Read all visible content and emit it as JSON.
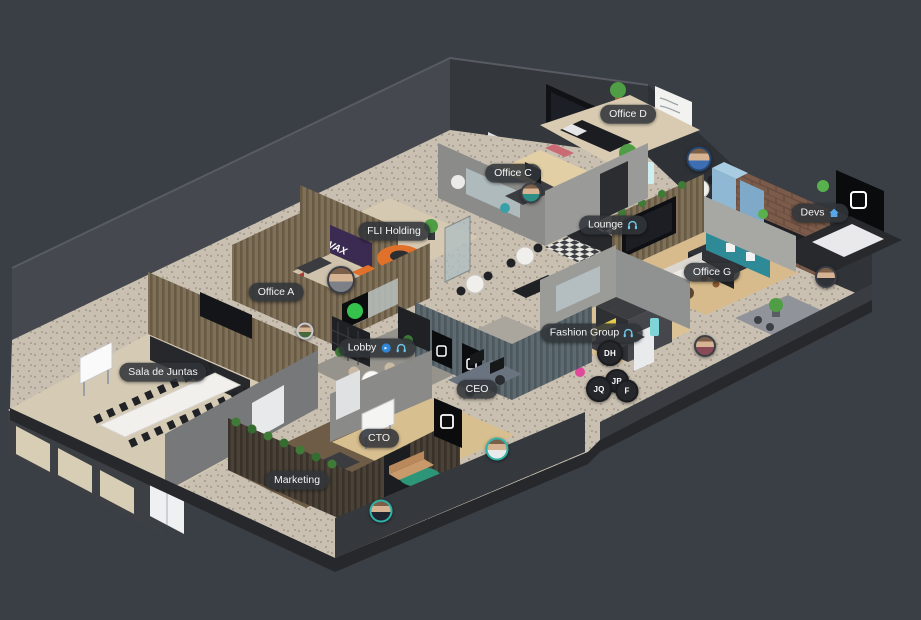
{
  "scene": {
    "name": "virtual-office-floorplan",
    "background_color": "#3a3e45",
    "floor_color": "#c9c0b1",
    "wood_floor_color": "#d9c9a8"
  },
  "signage": {
    "vax_screen": "VAX"
  },
  "icon_colors": {
    "headphones": "#6ec6e8",
    "home": "#58a6e8",
    "audio": "#2f86d6"
  },
  "label_style": {
    "bg": "rgba(49,52,57,0.88)",
    "text_color": "#f3f4f5"
  },
  "badge_style": {
    "bg": "#26272b",
    "text_color": "#ffffff"
  },
  "rooms": [
    {
      "id": "office-d",
      "label": "Office D",
      "icons": [],
      "x": 628,
      "y": 114
    },
    {
      "id": "office-c",
      "label": "Office C",
      "icons": [],
      "x": 513,
      "y": 173
    },
    {
      "id": "lounge",
      "label": "Lounge",
      "icons": [
        "headphones"
      ],
      "x": 613,
      "y": 225
    },
    {
      "id": "devs",
      "label": "Devs",
      "icons": [
        "home"
      ],
      "x": 820,
      "y": 213
    },
    {
      "id": "fli-holding",
      "label": "FLI Holding",
      "icons": [],
      "x": 394,
      "y": 231
    },
    {
      "id": "office-a",
      "label": "Office A",
      "icons": [],
      "x": 276,
      "y": 292
    },
    {
      "id": "office-g",
      "label": "Office G",
      "icons": [],
      "x": 712,
      "y": 272
    },
    {
      "id": "fashion-group",
      "label": "Fashion Group",
      "icons": [
        "headphones"
      ],
      "x": 592,
      "y": 333
    },
    {
      "id": "lobby",
      "label": "Lobby",
      "icons": [
        "audio",
        "headphones"
      ],
      "x": 377,
      "y": 348
    },
    {
      "id": "sala-de-juntas",
      "label": "Sala de Juntas",
      "icons": [],
      "x": 163,
      "y": 372
    },
    {
      "id": "ceo",
      "label": "CEO",
      "icons": [],
      "x": 477,
      "y": 389
    },
    {
      "id": "cto",
      "label": "CTO",
      "icons": [],
      "x": 379,
      "y": 438
    },
    {
      "id": "marketing",
      "label": "Marketing",
      "icons": [],
      "x": 297,
      "y": 480
    }
  ],
  "participant_badges": [
    {
      "initials": "DH",
      "x": 610,
      "y": 353,
      "size": 22
    },
    {
      "initials": "JB",
      "x": 617,
      "y": 381,
      "size": 20
    },
    {
      "initials": "JQ",
      "x": 599,
      "y": 389,
      "size": 22
    },
    {
      "initials": "F",
      "x": 627,
      "y": 391,
      "size": 19
    }
  ],
  "avatars": [
    {
      "id": "avatar-office-a",
      "x": 341,
      "y": 280,
      "size": 24,
      "ring": "#3b3e44",
      "shirt": "#7d8187"
    },
    {
      "id": "avatar-lounge",
      "x": 699,
      "y": 159,
      "size": 21,
      "ring": "#24466e",
      "shirt": "#3d6eb4"
    },
    {
      "id": "avatar-devs",
      "x": 826,
      "y": 277,
      "size": 18,
      "ring": "#3b3e44",
      "shirt": "#2f3237"
    },
    {
      "id": "avatar-office-g",
      "x": 705,
      "y": 346,
      "size": 18,
      "ring": "#3b3e44",
      "shirt": "#874a56"
    },
    {
      "id": "avatar-ceo",
      "x": 497,
      "y": 449,
      "size": 19,
      "ring": "#2fb3a6",
      "shirt": "#e9eaec"
    },
    {
      "id": "avatar-cto",
      "x": 381,
      "y": 511,
      "size": 19,
      "ring": "#2fb3a6",
      "shirt": "#1f2430"
    },
    {
      "id": "avatar-hallway",
      "x": 305,
      "y": 331,
      "size": 13,
      "ring": "#c6c9cd",
      "shirt": "#47683c"
    },
    {
      "id": "avatar-office-c",
      "x": 531,
      "y": 193,
      "size": 17,
      "ring": "#3b3e44",
      "shirt": "#2e8f86"
    }
  ]
}
